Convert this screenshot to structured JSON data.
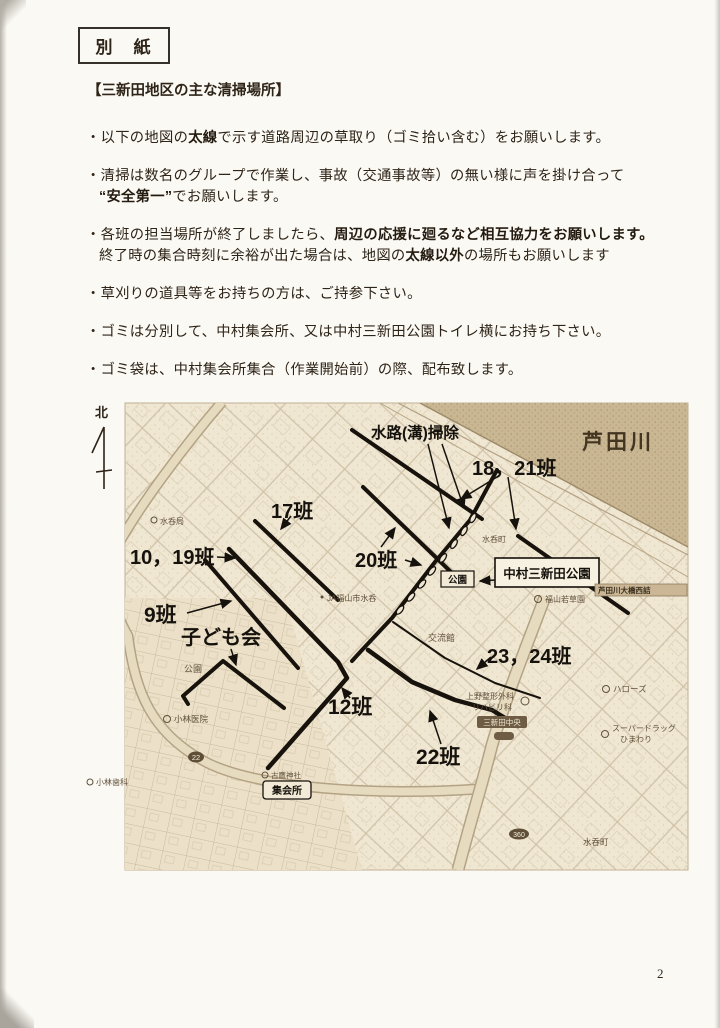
{
  "doc": {
    "title_box": "別　紙",
    "heading": "【三新田地区の主な清掃場所】",
    "bullets": {
      "b1a": "・以下の地図の",
      "b1b": "太線",
      "b1c": "で示す道路周辺の草取り（ゴミ拾い含む）をお願いします。",
      "b2l1": "・清掃は数名のグループで作業し、事故（交通事故等）の無い様に声を掛け合って",
      "b2l2a": "“安全第一”",
      "b2l2b": "でお願いします。",
      "b3l1a": "・各班の担当場所が終了しましたら、",
      "b3l1b": "周辺の応援に廻るなど相互協力をお願いします。",
      "b3l2a": "終了時の集合時刻に余裕が出た場合は、地図の",
      "b3l2b": "太線以外",
      "b3l2c": "の場所もお願いします",
      "b4": "・草刈りの道具等をお持ちの方は、ご持参下さい。",
      "b5": "・ゴミは分別して、中村集会所、又は中村三新田公園トイレ横にお持ち下さい。",
      "b6": "・ゴミ袋は、中村集会所集合（作業開始前）の際、配布致します。"
    },
    "page_number": "2"
  },
  "map": {
    "compass": "北",
    "river": "芦田川",
    "big_labels": {
      "suiro": "水路(溝)掃除",
      "g1821": "18，21班",
      "g17": "17班",
      "g1019": "10，19班",
      "g20": "20班",
      "g9": "9班",
      "kodomo": "子ども会",
      "g12": "12班",
      "g2324": "23，24班",
      "g22": "22班"
    },
    "boxes": {
      "koen": "公園",
      "nakamura": "中村三新田公園",
      "shukaisho": "集会所"
    },
    "small": {
      "mizunomi_kyoku": "水呑局",
      "ja": "JA福山市水呑",
      "mizunomi_cho_upper": "水呑町",
      "wakakusa": "福山若草園",
      "ohashi": "芦田川大橋西詰",
      "koryukan": "交流館",
      "ueno1": "上野整形外科",
      "ueno2": "リハビリ科",
      "chuo": "三新田中央",
      "hellows": "ハローズ",
      "drug1": "スーパードラッグ",
      "drug2": "ひまわり",
      "mizunomi_cho_lower": "水呑町",
      "kobayashi_iin": "小林医院",
      "kobayashi_shika": "小林歯科",
      "jinja": "古鷹神社",
      "koen_sw": "公園",
      "route22": "22",
      "route360": "360"
    },
    "colors": {
      "bold_line": "#17120c",
      "paper": "#f0e7d3",
      "river": "#c9b693"
    }
  }
}
